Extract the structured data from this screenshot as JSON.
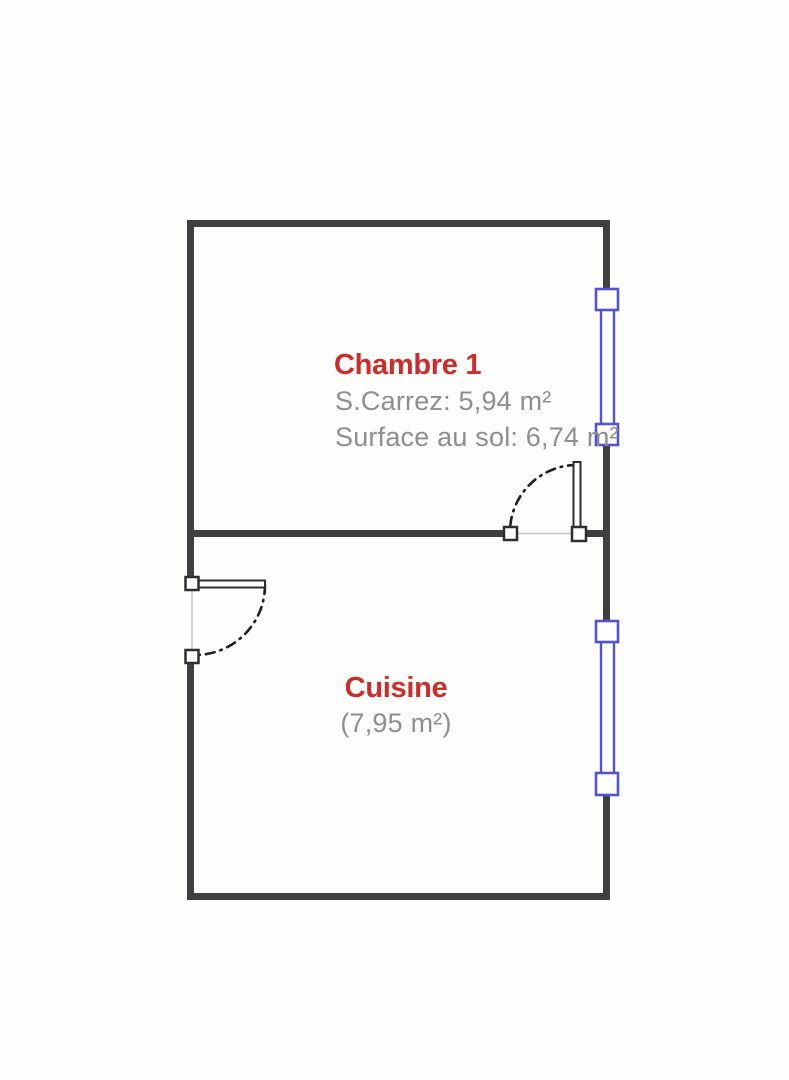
{
  "rooms": [
    {
      "name": "Chambre 1",
      "line1": "S.Carrez: 5,94 m²",
      "line2": "Surface au sol: 6,74 m²"
    },
    {
      "name": "Cuisine",
      "line1": "(7,95 m²)"
    }
  ],
  "colors": {
    "wall": "#3f3f3f",
    "window": "#5353d1",
    "door": "#2e2e2e",
    "arc": "#1f1f1f",
    "thin_line": "#c9c9c9",
    "room_name": "#cf2b2b",
    "room_info": "#8e8e8e",
    "background": "#fdfdfc"
  }
}
